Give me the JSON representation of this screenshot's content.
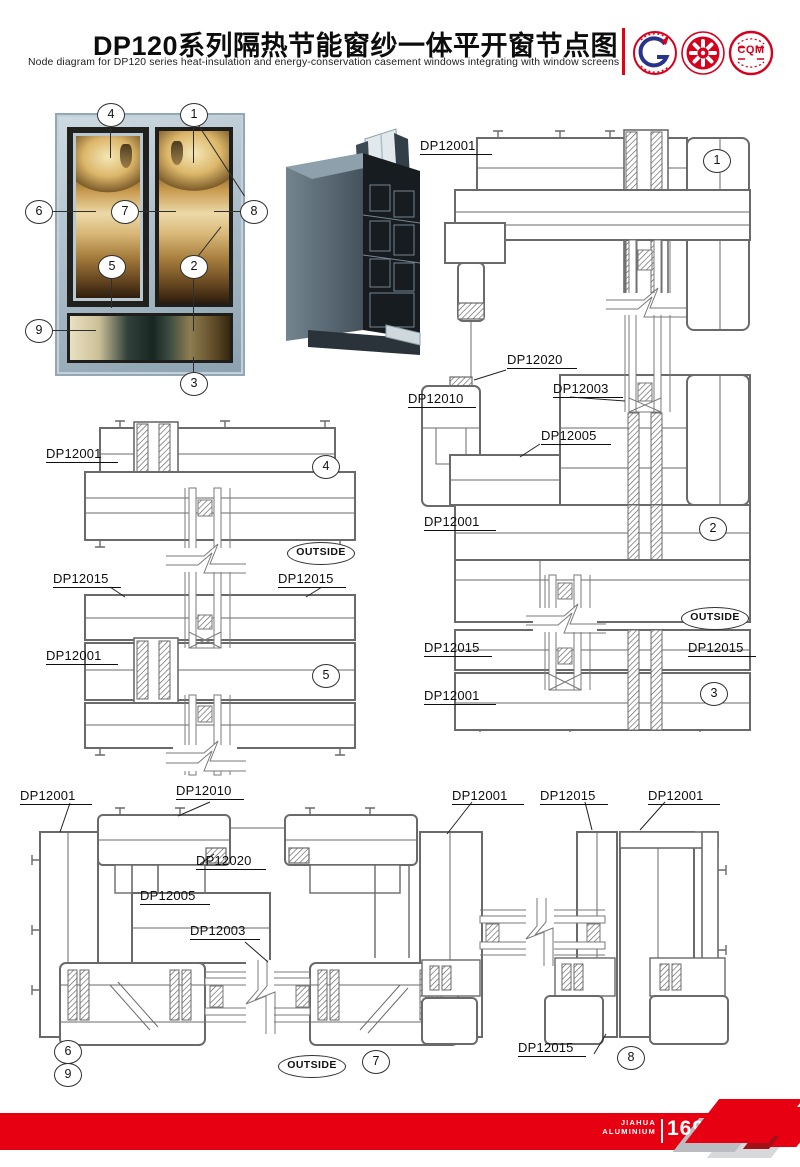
{
  "header": {
    "title": "DP120系列隔热节能窗纱一体平开窗节点图",
    "subtitle": "Node diagram for DP120 series heat-insulation and energy-conservation casement windows integrating with window screens",
    "cqm_text": "CQM"
  },
  "callouts": [
    "1",
    "2",
    "3",
    "4",
    "5",
    "6",
    "7",
    "8",
    "9"
  ],
  "labels": {
    "dp12001": "DP12001",
    "dp12003": "DP12003",
    "dp12005": "DP12005",
    "dp12010": "DP12010",
    "dp12015": "DP12015",
    "dp12020": "DP12020"
  },
  "outside": "OUTSIDE",
  "footer": {
    "brand_top": "JIAHUA",
    "brand_bottom": "ALUMINIUM",
    "page": "169"
  },
  "colors": {
    "accent_red": "#e60012",
    "drawing_line": "#6a6a6a",
    "frame_blue": "#a7b9c5"
  }
}
